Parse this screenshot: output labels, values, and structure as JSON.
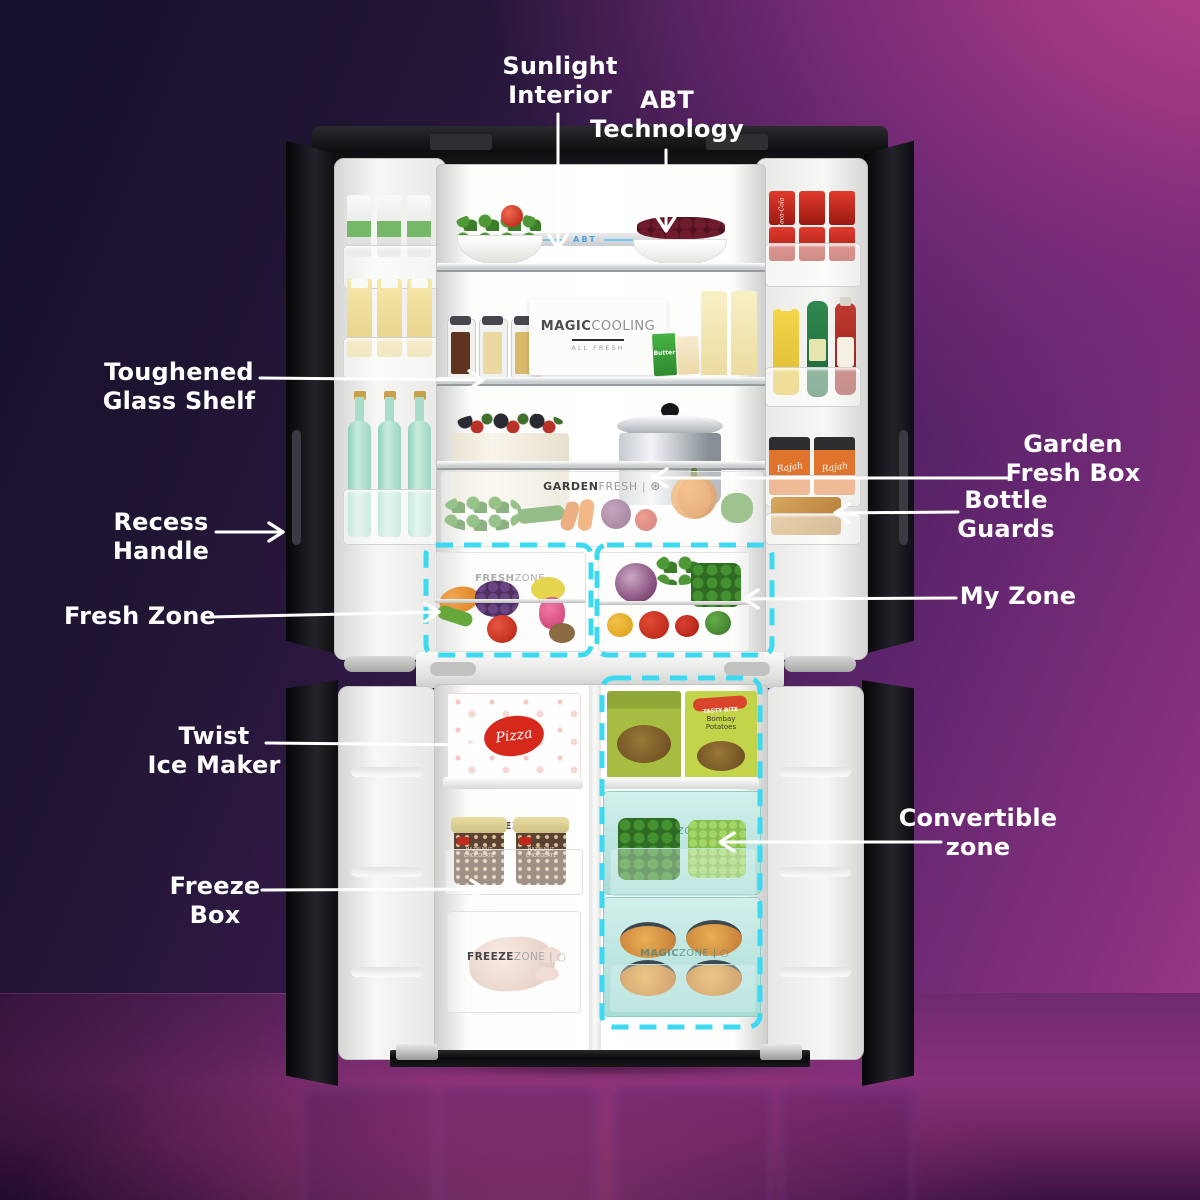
{
  "colors": {
    "accent_dash_cyan": "#3cd9f0",
    "callout_white": "#ffffff",
    "wall_dark": "#17102a",
    "wall_magenta": "#a93c85",
    "abt_blue": "#4aa0dc",
    "pizza_red": "#d6291c",
    "cola_red": "#d73227"
  },
  "callouts": {
    "sunlight": "Sunlight\nInterior",
    "abt": "ABT\nTechnology",
    "toughened": "Toughened\nGlass Shelf",
    "recess": "Recess\nHandle",
    "fresh_zone": "Fresh Zone",
    "twist": "Twist\nIce Maker",
    "freeze_box": "Freeze\nBox",
    "garden_fresh": "Garden\nFresh Box",
    "bottle_guards": "Bottle\nGuards",
    "my_zone": "My Zone",
    "convertible": "Convertible\nzone"
  },
  "interior": {
    "abt_strip": "ABT",
    "magic_bold": "MAGIC",
    "magic_light": "COOLING",
    "magic_sub": "ALL FRESH",
    "garden_bold": "GARDEN",
    "garden_light": "FRESH",
    "garden_sep": "|",
    "garden_icon": "⊛",
    "fresh_wm_bold": "FRESH",
    "fresh_wm_light": "ZONE",
    "freeze_wm_bold": "FREEZE",
    "freeze_wm_light": "ZONE",
    "magic_wm_bold": "MAGIC",
    "magic_wm_light": "ZONE",
    "wm_tail": "| ○",
    "pizza": "Pizza",
    "tub_label": "HAZELNUT\nCHOCOLATE",
    "butter": "Butter",
    "tasty_bite": "TASTY BITE",
    "bombay": "Bombay\nPotatoes",
    "cola": "Coca-Cola",
    "rajah": "Rajah"
  }
}
